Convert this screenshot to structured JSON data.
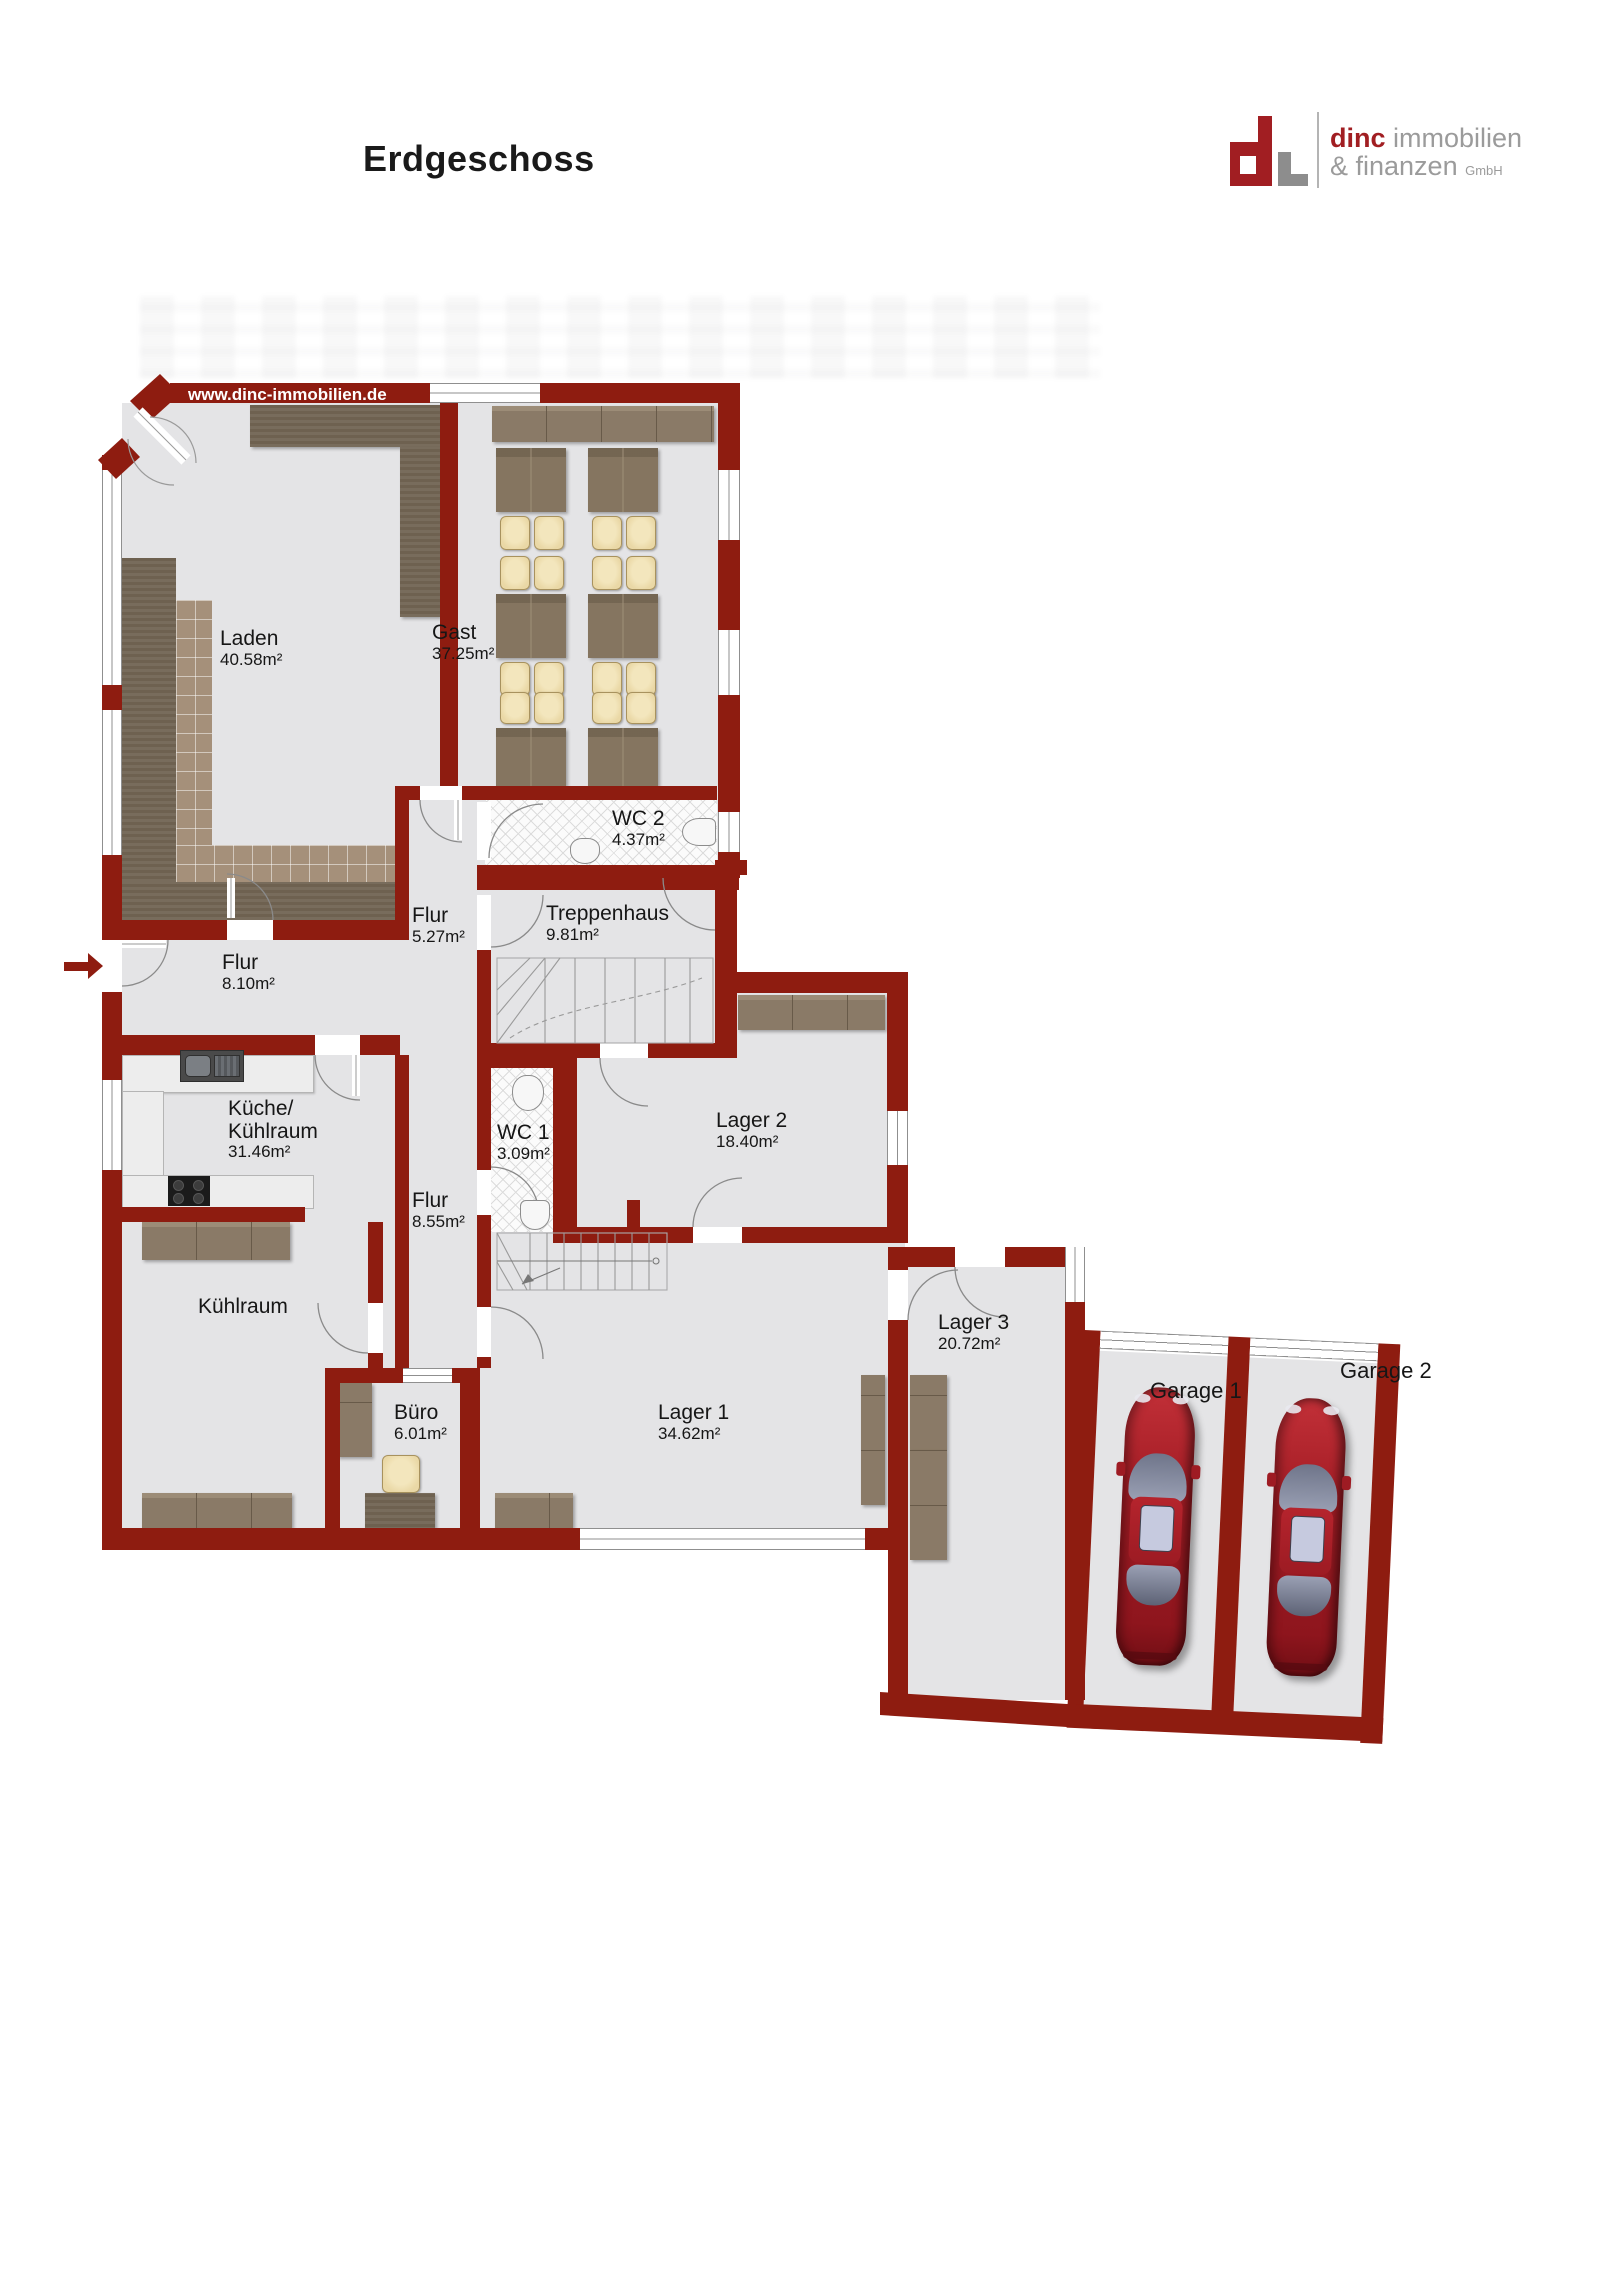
{
  "header": {
    "title": "Erdgeschoss"
  },
  "logo": {
    "brand": "dinc",
    "brand_rest": "immobilien",
    "line2": "& finanzen",
    "suffix": "GmbH"
  },
  "watermark": "www.dinc-immobilien.de",
  "rooms": {
    "laden": {
      "name": "Laden",
      "area": "40.58m²"
    },
    "gast": {
      "name": "Gast",
      "area": "37.25m²"
    },
    "wc2": {
      "name": "WC 2",
      "area": "4.37m²"
    },
    "flur_og": {
      "name": "Flur",
      "area": "5.27m²"
    },
    "treppenhaus": {
      "name": "Treppenhaus",
      "area": "9.81m²"
    },
    "flur_eingang": {
      "name": "Flur",
      "area": "8.10m²"
    },
    "kueche": {
      "name": "Küche/",
      "name2": "Kühlraum",
      "area": "31.46m²"
    },
    "wc1": {
      "name": "WC 1",
      "area": "3.09m²"
    },
    "lager2": {
      "name": "Lager 2",
      "area": "18.40m²"
    },
    "flur_mitte": {
      "name": "Flur",
      "area": "8.55m²"
    },
    "kuehlraum": {
      "name": "Kühlraum"
    },
    "buero": {
      "name": "Büro",
      "area": "6.01m²"
    },
    "lager1": {
      "name": "Lager 1",
      "area": "34.62m²"
    },
    "lager3": {
      "name": "Lager 3",
      "area": "20.72m²"
    },
    "garage1": {
      "name": "Garage 1"
    },
    "garage2": {
      "name": "Garage 2"
    }
  },
  "colors": {
    "wall": "#8e1c10",
    "floor": "#e4e4e6",
    "logo_red": "#a11e22",
    "logo_gray": "#9b9b9b",
    "furniture_dark": "#6e6150",
    "furniture_wood": "#8a7a67",
    "chair": "#ead8a6",
    "car": "#a81f26"
  }
}
